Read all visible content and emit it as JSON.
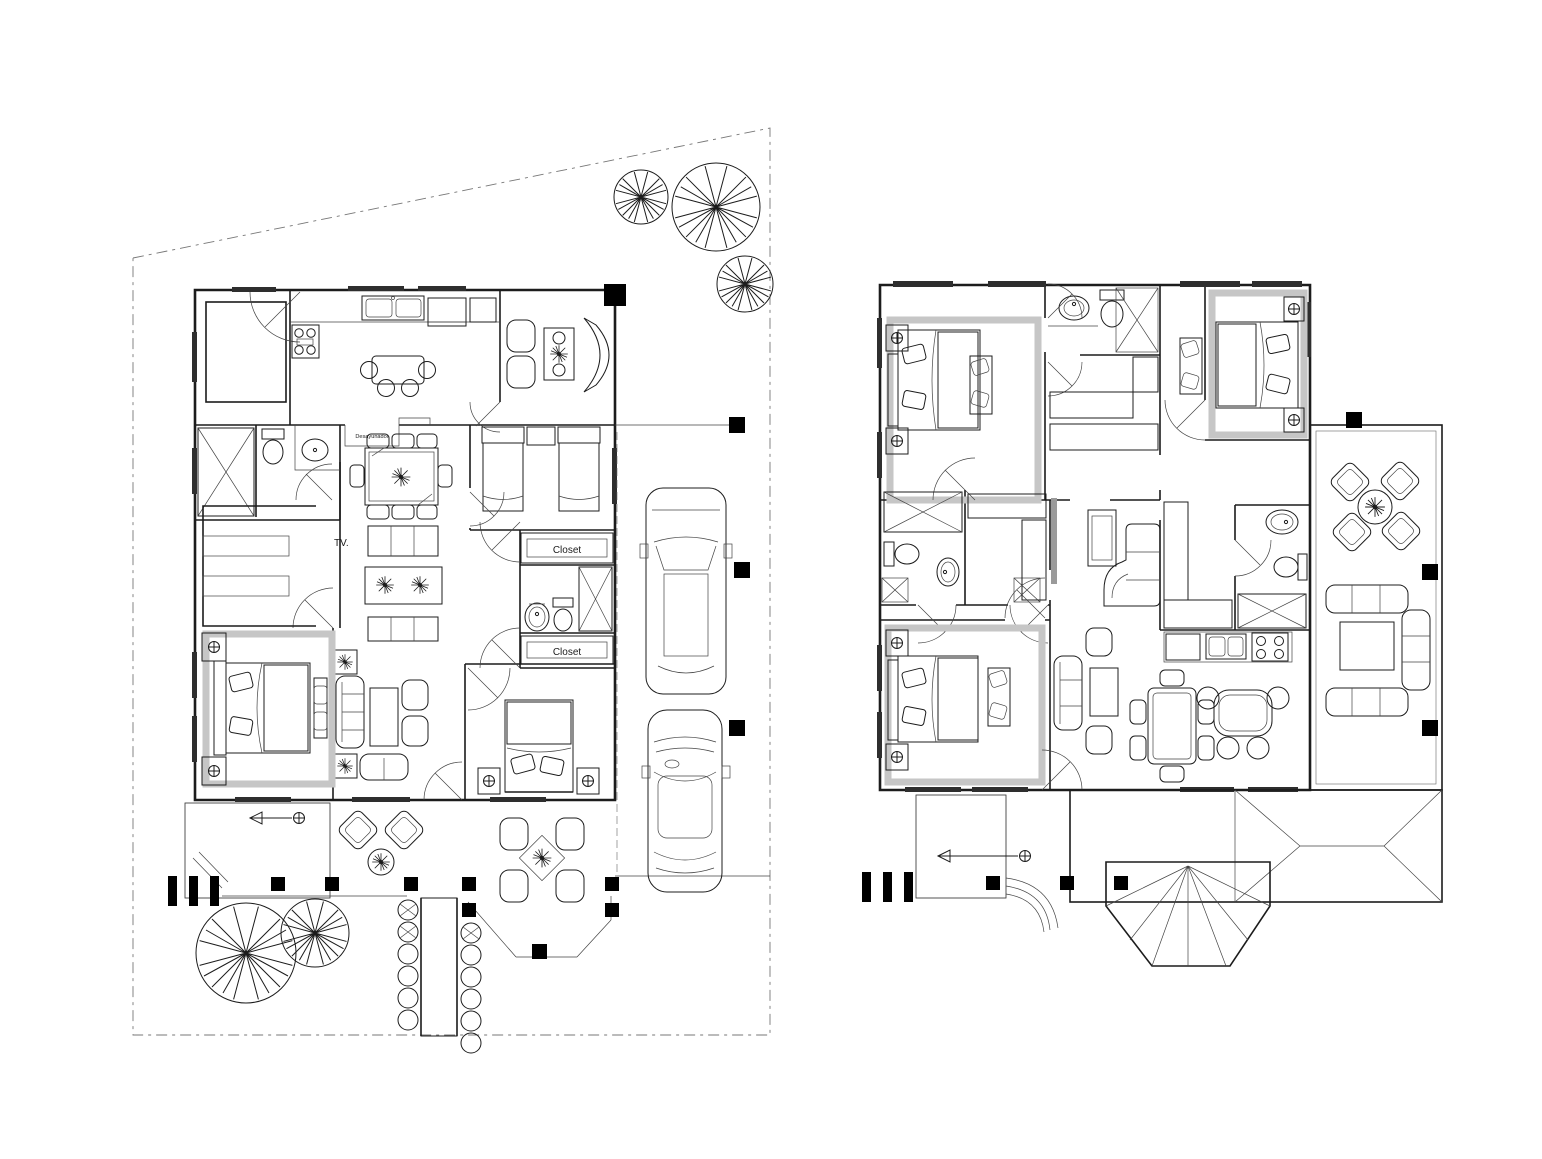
{
  "sheet": {
    "type": "architectural-floor-plan-drawing",
    "background": "#ffffff",
    "ink": "#1c1c1c",
    "plans": [
      {
        "name": "ground-floor-site-plan",
        "position": "left"
      },
      {
        "name": "upper-floor-plan",
        "position": "right"
      }
    ]
  },
  "labels": {
    "breakfast_nook": "Desayunador",
    "tv": "TV.",
    "closet_upper": "Closet",
    "closet_lower": "Closet"
  },
  "colors": {
    "line": "#1c1c1c",
    "light_hatch": "#c6c6c6",
    "column_fill": "#000000",
    "window_fill": "#2e2e2e"
  },
  "symbols": [
    "queen-bed",
    "twin-bed",
    "toilet",
    "sink",
    "shower",
    "stove",
    "kitchen-sink",
    "refrigerator",
    "breakfast-table",
    "dining-table",
    "round-table",
    "sofa",
    "sectional-sofa",
    "armchair",
    "coffee-table",
    "tv-console",
    "wardrobe-hatch",
    "plant",
    "shrub",
    "tree",
    "suv-car",
    "sedan-car",
    "stairs",
    "walkway",
    "column",
    "window",
    "door-swing",
    "tiled-terrace",
    "hip-roof",
    "fan-roof",
    "patio-chair"
  ]
}
